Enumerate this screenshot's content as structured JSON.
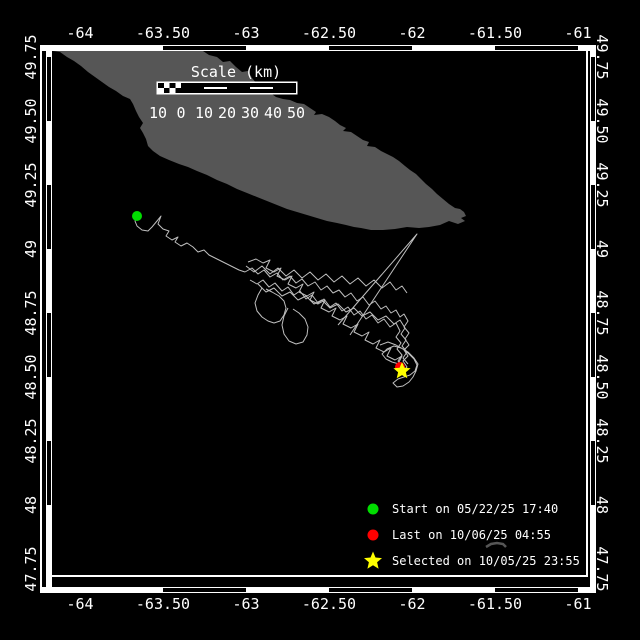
{
  "colors": {
    "background": "#000000",
    "frame": "#ffffff",
    "land": "#565656",
    "track": "#bfbfbf",
    "text": "#ffffff",
    "start": "#00dd00",
    "last": "#ff0000",
    "selected": "#ffff00"
  },
  "axes": {
    "lon_ticks": [
      [
        "-64",
        80
      ],
      [
        "-63.50",
        163
      ],
      [
        "-63",
        246
      ],
      [
        "-62.50",
        329
      ],
      [
        "-62",
        412
      ],
      [
        "-61.50",
        495
      ],
      [
        "-61",
        578
      ]
    ],
    "lat_ticks": [
      [
        "49.75",
        57
      ],
      [
        "49.50",
        121
      ],
      [
        "49.25",
        185
      ],
      [
        "49",
        249
      ],
      [
        "48.75",
        313
      ],
      [
        "48.50",
        377
      ],
      [
        "48.25",
        441
      ],
      [
        "48",
        505
      ],
      [
        "47.75",
        569
      ]
    ],
    "black_segments_x": [
      [
        163,
        246
      ],
      [
        329,
        412
      ],
      [
        495,
        578
      ]
    ],
    "black_segments_y": [
      [
        57,
        121
      ],
      [
        185,
        249
      ],
      [
        313,
        377
      ],
      [
        441,
        505
      ]
    ]
  },
  "scalebar": {
    "title": "Scale (km)",
    "labels": [
      "10",
      "0",
      "10",
      "20",
      "30",
      "40",
      "50"
    ],
    "origin_x": 158,
    "origin_y": 83,
    "segment_width": 23,
    "height": 10,
    "segment_styles": [
      "checker",
      "solid",
      "striped",
      "solid",
      "striped",
      "solid"
    ],
    "labels_y": 118,
    "title_x": 236,
    "title_y": 77
  },
  "legend": {
    "marker_x": 373,
    "text_x": 392,
    "rows_y": [
      509,
      535,
      561
    ],
    "items": [
      {
        "marker": "circle",
        "color": "#00dd00",
        "label": "Start on 05/22/25 17:40"
      },
      {
        "marker": "circle",
        "color": "#ff0000",
        "label": "Last on 10/06/25 04:55"
      },
      {
        "marker": "star",
        "color": "#ffff00",
        "label": "Selected on 10/05/25 23:55"
      }
    ]
  },
  "map": {
    "island": [
      [
        53,
        51
      ],
      [
        203,
        51
      ],
      [
        209,
        55
      ],
      [
        217,
        57
      ],
      [
        223,
        62
      ],
      [
        230,
        61
      ],
      [
        236,
        67
      ],
      [
        242,
        72
      ],
      [
        248,
        71
      ],
      [
        252,
        78
      ],
      [
        257,
        84
      ],
      [
        263,
        87
      ],
      [
        261,
        91
      ],
      [
        269,
        92
      ],
      [
        276,
        97
      ],
      [
        283,
        99
      ],
      [
        290,
        100
      ],
      [
        297,
        103
      ],
      [
        304,
        104
      ],
      [
        310,
        108
      ],
      [
        316,
        112
      ],
      [
        314,
        115
      ],
      [
        322,
        114
      ],
      [
        329,
        117
      ],
      [
        335,
        121
      ],
      [
        340,
        125
      ],
      [
        346,
        128
      ],
      [
        343,
        131
      ],
      [
        351,
        132
      ],
      [
        357,
        136
      ],
      [
        363,
        140
      ],
      [
        369,
        142
      ],
      [
        367,
        146
      ],
      [
        375,
        147
      ],
      [
        381,
        151
      ],
      [
        387,
        154
      ],
      [
        393,
        157
      ],
      [
        399,
        161
      ],
      [
        405,
        166
      ],
      [
        410,
        170
      ],
      [
        416,
        174
      ],
      [
        421,
        179
      ],
      [
        426,
        184
      ],
      [
        432,
        189
      ],
      [
        437,
        194
      ],
      [
        443,
        199
      ],
      [
        449,
        204
      ],
      [
        455,
        208
      ],
      [
        460,
        209
      ],
      [
        464,
        212
      ],
      [
        466,
        216
      ],
      [
        461,
        218
      ],
      [
        465,
        221
      ],
      [
        458,
        224
      ],
      [
        449,
        221
      ],
      [
        440,
        225
      ],
      [
        429,
        227
      ],
      [
        419,
        228
      ],
      [
        407,
        227
      ],
      [
        395,
        229
      ],
      [
        383,
        230
      ],
      [
        371,
        230
      ],
      [
        361,
        228
      ],
      [
        354,
        227
      ],
      [
        346,
        225
      ],
      [
        337,
        223
      ],
      [
        327,
        221
      ],
      [
        317,
        218
      ],
      [
        307,
        215
      ],
      [
        297,
        212
      ],
      [
        287,
        209
      ],
      [
        277,
        205
      ],
      [
        267,
        201
      ],
      [
        257,
        197
      ],
      [
        247,
        193
      ],
      [
        237,
        189
      ],
      [
        227,
        184
      ],
      [
        217,
        180
      ],
      [
        207,
        175
      ],
      [
        197,
        171
      ],
      [
        188,
        167
      ],
      [
        179,
        164
      ],
      [
        169,
        160
      ],
      [
        160,
        156
      ],
      [
        153,
        151
      ],
      [
        148,
        146
      ],
      [
        146,
        139
      ],
      [
        143,
        133
      ],
      [
        140,
        128
      ],
      [
        143,
        123
      ],
      [
        139,
        117
      ],
      [
        136,
        111
      ],
      [
        133,
        104
      ],
      [
        130,
        99
      ],
      [
        123,
        96
      ],
      [
        116,
        91
      ],
      [
        109,
        87
      ],
      [
        102,
        82
      ],
      [
        95,
        77
      ],
      [
        88,
        72
      ],
      [
        81,
        66
      ],
      [
        74,
        61
      ],
      [
        67,
        57
      ],
      [
        60,
        52
      ]
    ],
    "islet": [
      [
        486,
        547
      ],
      [
        491,
        544
      ],
      [
        497,
        543
      ],
      [
        503,
        544
      ],
      [
        506,
        547
      ]
    ],
    "tracks": [
      [
        [
          137,
          216
        ],
        [
          135,
          221
        ],
        [
          137,
          226
        ],
        [
          142,
          230
        ],
        [
          148,
          231
        ],
        [
          152,
          227
        ],
        [
          157,
          221
        ],
        [
          161,
          216
        ],
        [
          158,
          224
        ],
        [
          163,
          229
        ],
        [
          169,
          231
        ],
        [
          166,
          236
        ],
        [
          172,
          240
        ],
        [
          178,
          237
        ],
        [
          175,
          242
        ],
        [
          181,
          246
        ],
        [
          187,
          243
        ],
        [
          193,
          247
        ],
        [
          198,
          252
        ],
        [
          204,
          250
        ],
        [
          209,
          255
        ],
        [
          215,
          258
        ],
        [
          221,
          261
        ],
        [
          227,
          264
        ],
        [
          233,
          267
        ],
        [
          239,
          270
        ],
        [
          245,
          272
        ]
      ],
      [
        [
          245,
          272
        ],
        [
          252,
          268
        ],
        [
          258,
          274
        ],
        [
          264,
          270
        ],
        [
          270,
          277
        ],
        [
          277,
          273
        ],
        [
          283,
          280
        ],
        [
          290,
          276
        ],
        [
          296,
          283
        ],
        [
          302,
          279
        ],
        [
          308,
          286
        ],
        [
          315,
          282
        ],
        [
          321,
          290
        ],
        [
          327,
          286
        ],
        [
          333,
          293
        ],
        [
          339,
          290
        ],
        [
          345,
          297
        ],
        [
          351,
          293
        ],
        [
          357,
          301
        ],
        [
          363,
          297
        ],
        [
          369,
          305
        ],
        [
          375,
          301
        ],
        [
          381,
          309
        ],
        [
          386,
          306
        ],
        [
          391,
          313
        ],
        [
          396,
          310
        ],
        [
          400,
          317
        ],
        [
          404,
          314
        ],
        [
          408,
          321
        ],
        [
          404,
          327
        ],
        [
          409,
          333
        ],
        [
          405,
          339
        ],
        [
          409,
          345
        ],
        [
          404,
          350
        ],
        [
          408,
          356
        ],
        [
          403,
          361
        ],
        [
          407,
          367
        ],
        [
          402,
          372
        ]
      ],
      [
        [
          250,
          280
        ],
        [
          257,
          284
        ],
        [
          263,
          280
        ],
        [
          269,
          287
        ],
        [
          275,
          283
        ],
        [
          282,
          291
        ],
        [
          288,
          287
        ],
        [
          294,
          295
        ],
        [
          300,
          291
        ],
        [
          306,
          299
        ],
        [
          312,
          295
        ],
        [
          318,
          303
        ],
        [
          324,
          299
        ],
        [
          330,
          307
        ],
        [
          336,
          303
        ],
        [
          342,
          311
        ],
        [
          348,
          307
        ],
        [
          354,
          315
        ],
        [
          360,
          311
        ],
        [
          366,
          319
        ],
        [
          372,
          315
        ],
        [
          378,
          323
        ],
        [
          384,
          319
        ],
        [
          390,
          327
        ],
        [
          396,
          323
        ],
        [
          400,
          331
        ],
        [
          396,
          337
        ],
        [
          401,
          343
        ],
        [
          397,
          349
        ],
        [
          402,
          355
        ],
        [
          398,
          361
        ],
        [
          403,
          366
        ]
      ],
      [
        [
          248,
          262
        ],
        [
          256,
          259
        ],
        [
          263,
          263
        ],
        [
          270,
          260
        ],
        [
          266,
          268
        ],
        [
          274,
          272
        ],
        [
          281,
          268
        ],
        [
          277,
          276
        ],
        [
          285,
          280
        ],
        [
          292,
          276
        ],
        [
          288,
          284
        ],
        [
          296,
          288
        ],
        [
          303,
          284
        ],
        [
          299,
          292
        ],
        [
          307,
          296
        ],
        [
          314,
          292
        ],
        [
          310,
          300
        ],
        [
          318,
          304
        ],
        [
          325,
          300
        ],
        [
          321,
          308
        ],
        [
          329,
          312
        ],
        [
          336,
          308
        ],
        [
          332,
          316
        ],
        [
          340,
          320
        ],
        [
          347,
          316
        ],
        [
          343,
          324
        ],
        [
          351,
          328
        ],
        [
          358,
          324
        ],
        [
          354,
          332
        ],
        [
          362,
          336
        ],
        [
          369,
          332
        ],
        [
          365,
          340
        ],
        [
          373,
          344
        ],
        [
          380,
          340
        ],
        [
          376,
          348
        ],
        [
          384,
          352
        ],
        [
          391,
          348
        ],
        [
          387,
          356
        ],
        [
          395,
          360
        ],
        [
          402,
          356
        ],
        [
          398,
          364
        ],
        [
          405,
          368
        ]
      ],
      [
        [
          262,
          288
        ],
        [
          258,
          295
        ],
        [
          255,
          303
        ],
        [
          257,
          311
        ],
        [
          262,
          317
        ],
        [
          268,
          321
        ],
        [
          274,
          323
        ],
        [
          280,
          321
        ],
        [
          284,
          315
        ],
        [
          286,
          308
        ],
        [
          284,
          301
        ],
        [
          279,
          296
        ],
        [
          272,
          292
        ],
        [
          266,
          289
        ]
      ],
      [
        [
          288,
          308
        ],
        [
          284,
          316
        ],
        [
          282,
          325
        ],
        [
          284,
          334
        ],
        [
          289,
          341
        ],
        [
          296,
          344
        ],
        [
          303,
          342
        ],
        [
          307,
          335
        ],
        [
          308,
          327
        ],
        [
          305,
          319
        ],
        [
          299,
          313
        ],
        [
          293,
          309
        ]
      ],
      [
        [
          338,
          325
        ],
        [
          417,
          234
        ],
        [
          350,
          335
        ]
      ],
      [
        [
          380,
          345
        ],
        [
          388,
          342
        ],
        [
          396,
          345
        ],
        [
          403,
          349
        ],
        [
          409,
          354
        ],
        [
          414,
          359
        ],
        [
          417,
          365
        ],
        [
          415,
          371
        ],
        [
          410,
          375
        ],
        [
          404,
          377
        ],
        [
          398,
          379
        ],
        [
          393,
          383
        ],
        [
          397,
          387
        ],
        [
          403,
          386
        ],
        [
          409,
          382
        ],
        [
          413,
          377
        ],
        [
          416,
          371
        ],
        [
          418,
          364
        ],
        [
          414,
          358
        ],
        [
          408,
          352
        ],
        [
          401,
          348
        ],
        [
          394,
          346
        ],
        [
          387,
          349
        ],
        [
          382,
          354
        ],
        [
          386,
          359
        ],
        [
          392,
          362
        ],
        [
          399,
          364
        ],
        [
          405,
          367
        ]
      ],
      [
        [
          246,
          266
        ],
        [
          254,
          272
        ],
        [
          262,
          266
        ],
        [
          270,
          274
        ],
        [
          278,
          268
        ],
        [
          286,
          276
        ],
        [
          294,
          270
        ],
        [
          302,
          278
        ],
        [
          310,
          272
        ],
        [
          318,
          280
        ],
        [
          326,
          274
        ],
        [
          334,
          282
        ],
        [
          342,
          276
        ],
        [
          350,
          284
        ],
        [
          358,
          278
        ],
        [
          366,
          286
        ],
        [
          374,
          280
        ],
        [
          382,
          288
        ],
        [
          390,
          282
        ],
        [
          396,
          290
        ],
        [
          402,
          286
        ],
        [
          407,
          293
        ]
      ],
      [
        [
          258,
          284
        ],
        [
          266,
          292
        ],
        [
          274,
          288
        ],
        [
          282,
          296
        ],
        [
          290,
          292
        ],
        [
          298,
          300
        ],
        [
          306,
          296
        ],
        [
          314,
          304
        ],
        [
          322,
          300
        ],
        [
          330,
          308
        ],
        [
          338,
          304
        ],
        [
          346,
          312
        ],
        [
          354,
          308
        ],
        [
          362,
          316
        ],
        [
          370,
          312
        ],
        [
          378,
          320
        ],
        [
          386,
          316
        ],
        [
          394,
          324
        ],
        [
          400,
          320
        ],
        [
          405,
          328
        ],
        [
          401,
          334
        ],
        [
          406,
          340
        ],
        [
          402,
          346
        ],
        [
          407,
          352
        ],
        [
          403,
          358
        ],
        [
          408,
          364
        ]
      ]
    ],
    "markers": {
      "start": {
        "x": 137,
        "y": 216,
        "r": 5
      },
      "last": {
        "x": 400,
        "y": 367,
        "r": 5
      },
      "selected": {
        "x": 402,
        "y": 371,
        "r": 9
      }
    }
  }
}
